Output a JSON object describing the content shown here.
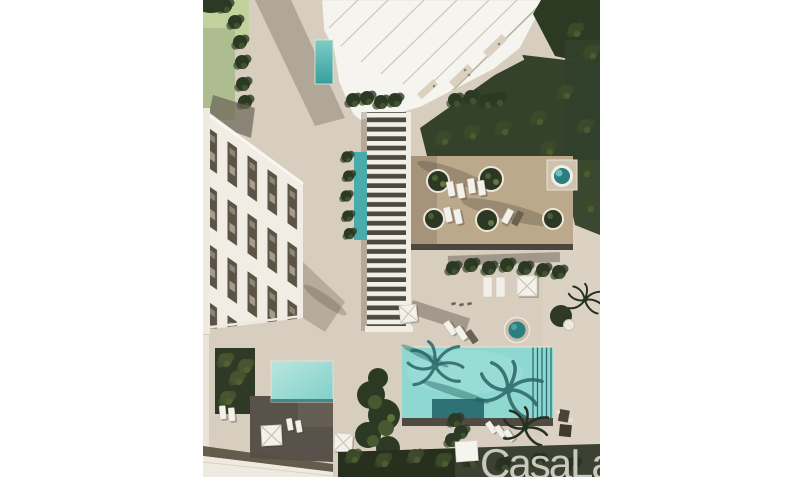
{
  "watermark": {
    "text": "CasaLa"
  },
  "palette": {
    "canvas_background": "#ffffff",
    "paving": "#d8cec0",
    "deck_wood": "#bca88b",
    "pool_water": "#8fd8d1",
    "lap_pool_water": "#55bcb7",
    "water_feature": "#4aacaa",
    "spa_water": "#2c7f81",
    "foliage_dark": "#2c3a24",
    "foliage_mid": "#3c4a2a",
    "lawn": "#c2d29c",
    "building_white": "#f6f4ef",
    "townhouse_terrace": "#5a5346",
    "pool_deck_dark": "#59524a",
    "shadow": "#8a7d6e",
    "watermark_color": "#d3d0c7"
  }
}
